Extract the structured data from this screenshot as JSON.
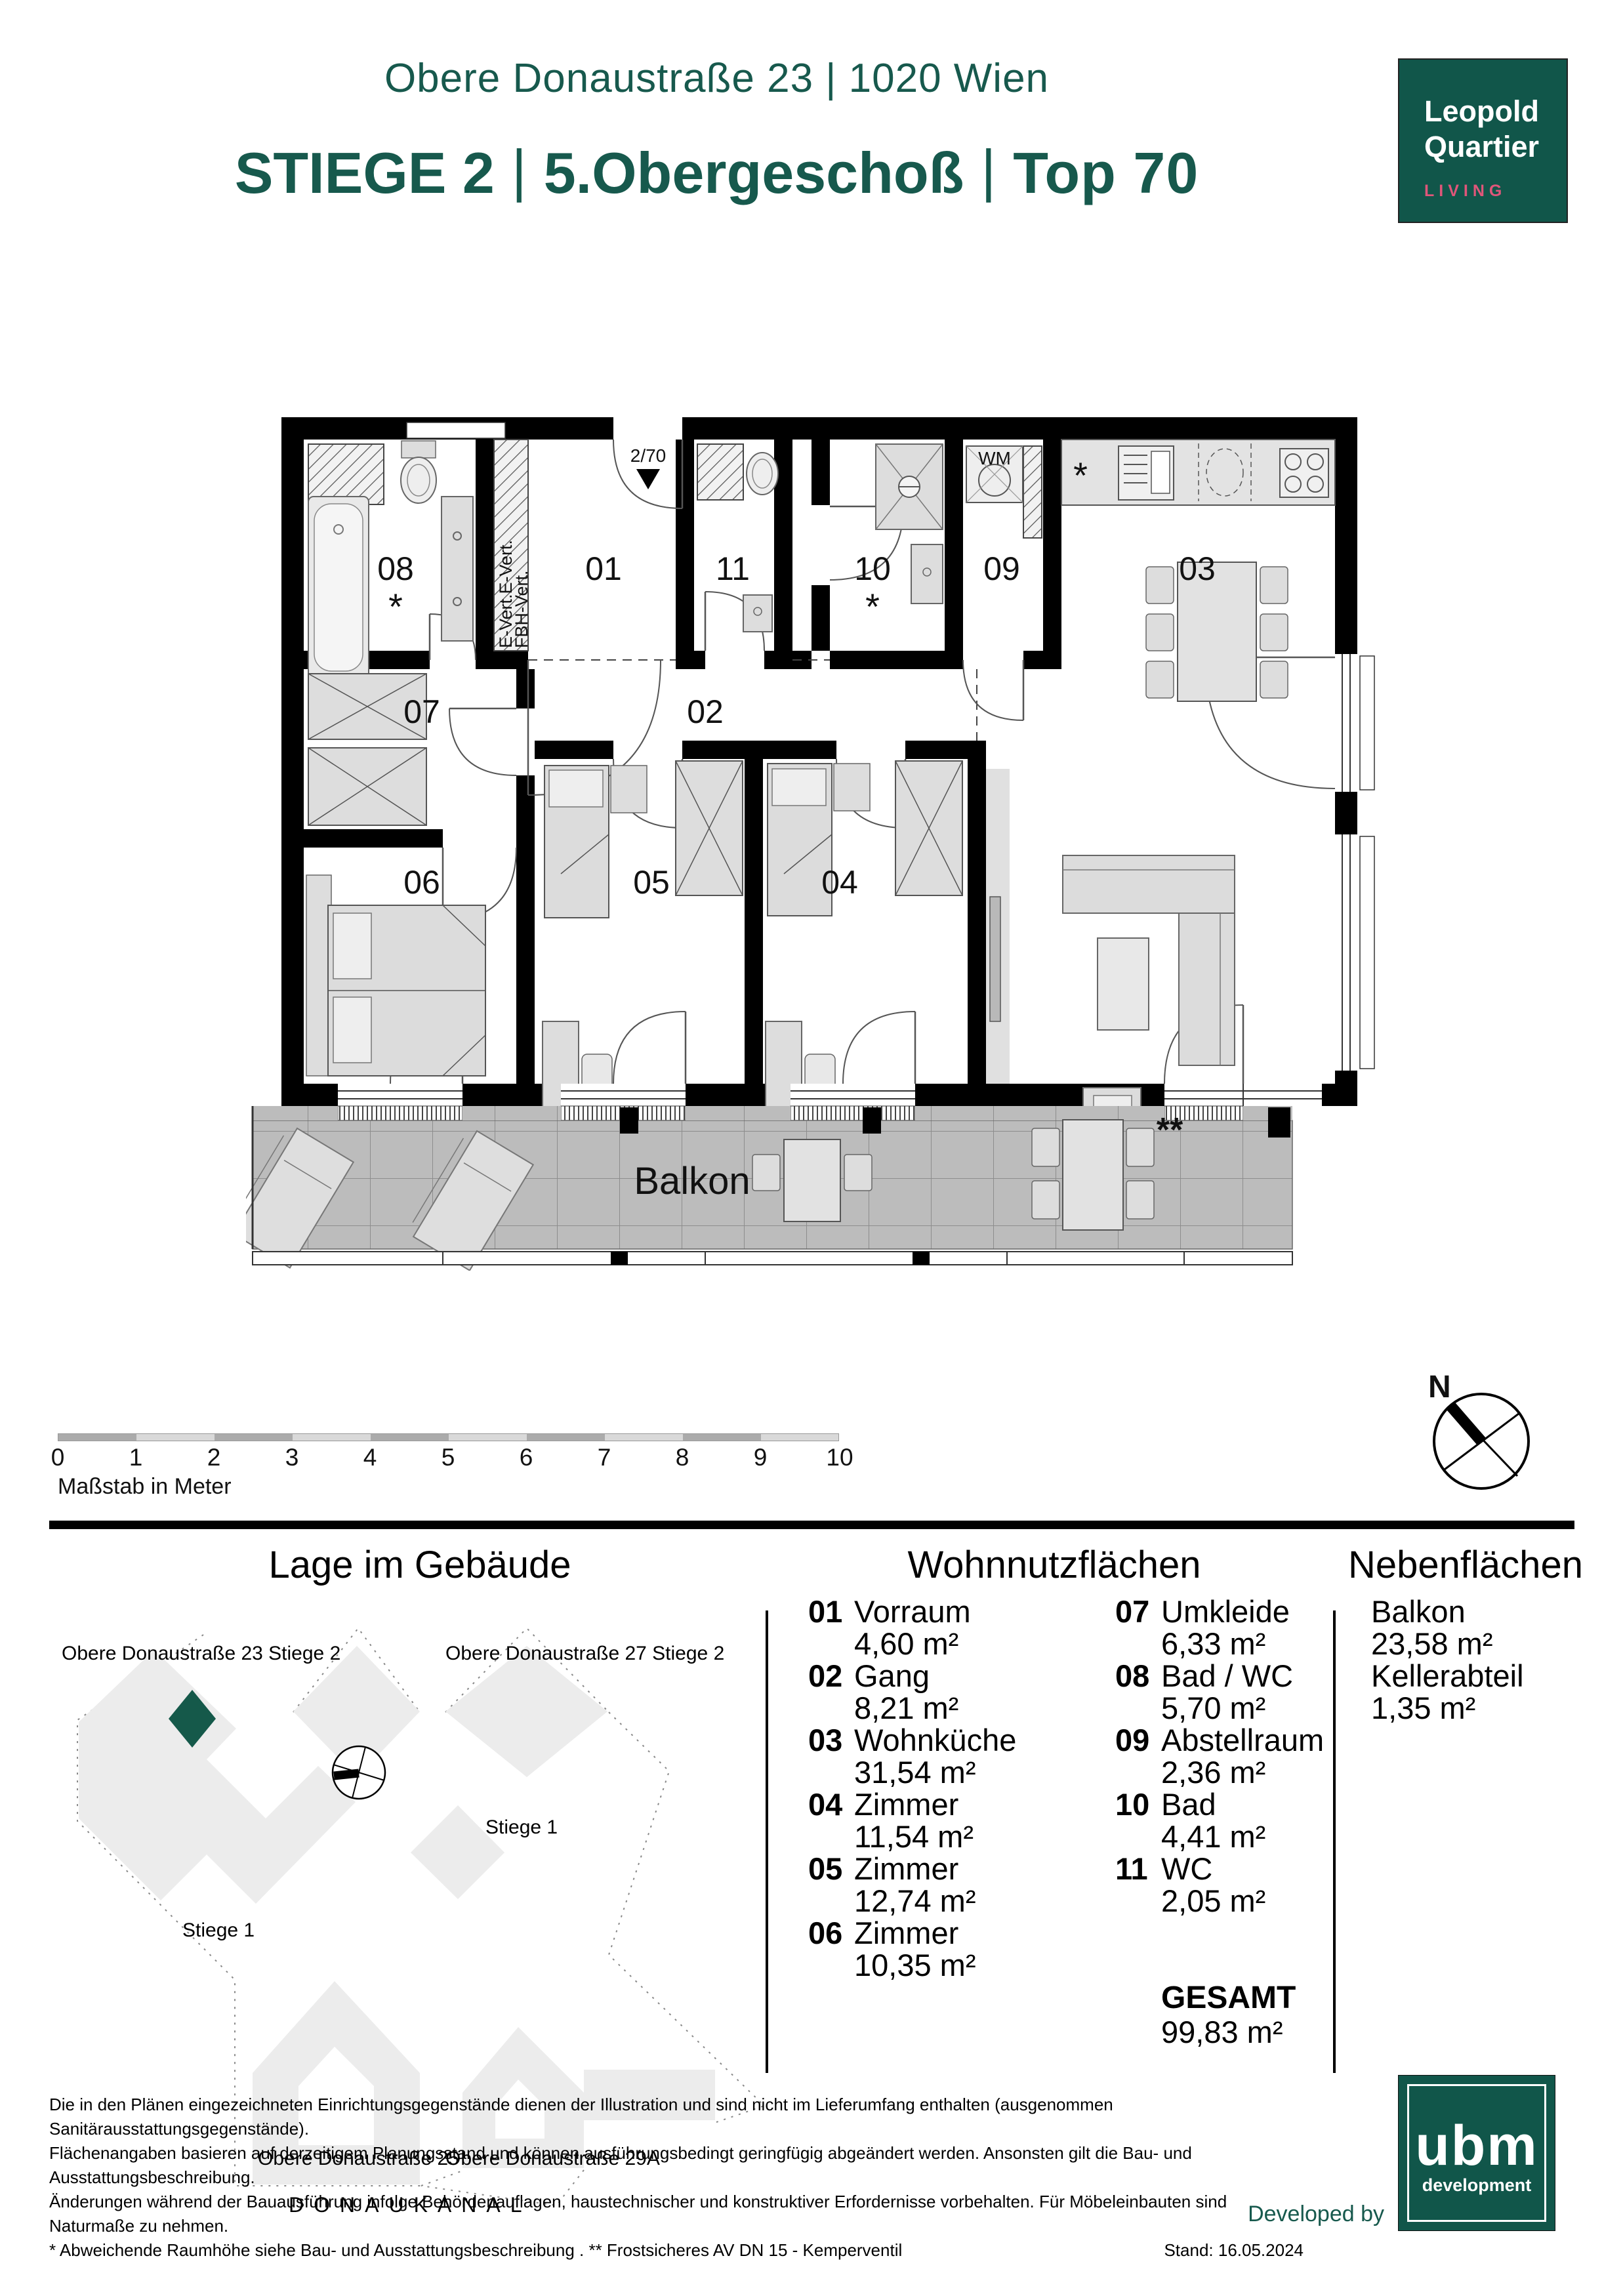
{
  "header": {
    "address": "Obere Donaustraße 23 | 1020 Wien",
    "stiege": "STIEGE 2",
    "floor": "5.Obergeschoß",
    "top_label": "Top 70",
    "separator": "|"
  },
  "brand": {
    "line1": "Leopold",
    "line2": "Quartier",
    "line3": "LIVING"
  },
  "colors": {
    "brand_green": "#11564a",
    "brand_pink": "#e0567a",
    "heading_green": "#17594d"
  },
  "plan": {
    "entrance_label": "2/70",
    "shaft_label_1": "E-Vert.E-Vert.",
    "shaft_label_2": "FBH-Vert.",
    "wm_label": "WM",
    "balcony_label": "Balkon",
    "star": "*",
    "double_star": "**",
    "rooms": [
      {
        "number": "08",
        "star": "*"
      },
      {
        "number": "01"
      },
      {
        "number": "11"
      },
      {
        "number": "10",
        "star": "*"
      },
      {
        "number": "09"
      },
      {
        "number": "03"
      },
      {
        "number": "07"
      },
      {
        "number": "02"
      },
      {
        "number": "06"
      },
      {
        "number": "05"
      },
      {
        "number": "04"
      }
    ]
  },
  "scalebar": {
    "ticks": [
      "0",
      "1",
      "2",
      "3",
      "4",
      "5",
      "6",
      "7",
      "8",
      "9",
      "10"
    ],
    "label": "Maßstab in Meter"
  },
  "compass": {
    "north_label": "N"
  },
  "site": {
    "title": "Lage im Gebäude",
    "labels": {
      "building_23": "Obere Donaustraße 23 Stiege 2",
      "building_27": "Obere Donaustraße 27 Stiege 2",
      "stiege1_right": "Stiege 1",
      "stiege1_left": "Stiege 1",
      "building_25": "Obere Donaustraße 25",
      "building_29a": "Obere Donaustraße 29A",
      "donaukanal": "DONAUKANAL"
    }
  },
  "areas": {
    "title": "Wohnnutzflächen",
    "column1": [
      {
        "num": "01",
        "name": "Vorraum",
        "area": "4,60 m²"
      },
      {
        "num": "02",
        "name": "Gang",
        "area": "8,21 m²"
      },
      {
        "num": "03",
        "name": "Wohnküche",
        "area": "31,54 m²"
      },
      {
        "num": "04",
        "name": "Zimmer",
        "area": "11,54 m²"
      },
      {
        "num": "05",
        "name": "Zimmer",
        "area": "12,74 m²"
      },
      {
        "num": "06",
        "name": "Zimmer",
        "area": "10,35 m²"
      }
    ],
    "column2": [
      {
        "num": "07",
        "name": "Umkleide",
        "area": "6,33 m²"
      },
      {
        "num": "08",
        "name": "Bad / WC",
        "area": "5,70 m²"
      },
      {
        "num": "09",
        "name": "Abstellraum",
        "area": "2,36 m²"
      },
      {
        "num": "10",
        "name": "Bad",
        "area": "4,41 m²"
      },
      {
        "num": "11",
        "name": "WC",
        "area": "2,05 m²"
      }
    ],
    "total_label": "GESAMT",
    "total_value": "99,83 m²"
  },
  "secondary": {
    "title": "Nebenflächen",
    "items": [
      {
        "name": "Balkon",
        "area": "23,58 m²"
      },
      {
        "name": "Kellerabteil",
        "area": "1,35 m²"
      }
    ]
  },
  "footer": {
    "line1": "Die in den Plänen eingezeichneten Einrichtungsgegenstände dienen der Illustration und sind nicht im Lieferumfang enthalten (ausgenommen Sanitärausstattungsgegenstände).",
    "line2": "Flächenangaben basieren auf derzeitigem Planungsstand und können ausführungsbedingt geringfügig abgeändert werden. Ansonsten gilt die Bau- und Ausstattungsbeschreibung.",
    "line3": "Änderungen während der Bauausführung infolge Behördenauflagen, haustechnischer und konstruktiver Erfordernisse vorbehalten. Für Möbeleinbauten sind Naturmaße zu nehmen.",
    "line4": "* Abweichende Raumhöhe siehe Bau- und Ausstattungsbeschreibung . ** Frostsicheres AV DN 15 - Kemperventil",
    "stand": "Stand: 16.05.2024",
    "developed_by": "Developed by",
    "ubm_name": "ubm",
    "ubm_sub": "development"
  }
}
